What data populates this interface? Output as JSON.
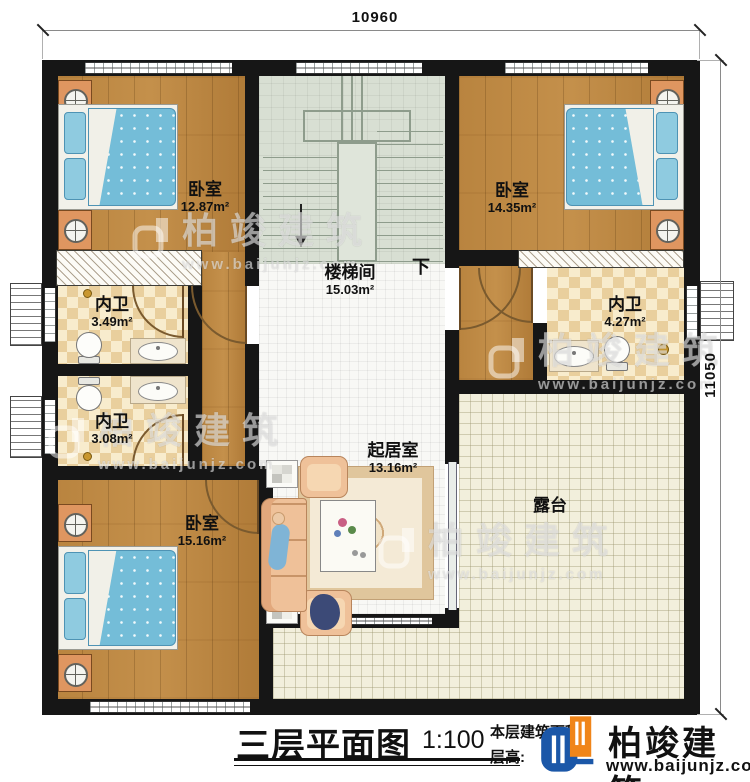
{
  "meta": {
    "sheet_title": "三层平面图",
    "scale": "1:100",
    "note_area_label": "本层建筑面积",
    "note_height_label": "层高:",
    "dim_width": "10960",
    "dim_height": "11050",
    "stair_direction": "下"
  },
  "rooms": {
    "bedroom1": {
      "name": "卧室",
      "area": "12.87m²"
    },
    "bedroom2": {
      "name": "卧室",
      "area": "14.35m²"
    },
    "stair": {
      "name": "楼梯间",
      "area": "15.03m²"
    },
    "bath1": {
      "name": "内卫",
      "area": "3.49m²"
    },
    "bath2": {
      "name": "内卫",
      "area": "3.08m²"
    },
    "bath3": {
      "name": "内卫",
      "area": "4.27m²"
    },
    "bedroom3": {
      "name": "卧室",
      "area": "15.16m²"
    },
    "living": {
      "name": "起居室",
      "area": "13.16m²"
    },
    "terrace": {
      "name": "露台"
    }
  },
  "brand": {
    "name": "柏竣建筑",
    "url": "www.baijunjz.com"
  },
  "watermark": {
    "name": "柏竣建筑",
    "url": "www.baijunjz.com"
  },
  "colors": {
    "wall": "#161616",
    "wood": "#b9843f",
    "checker": "#e9cf9d",
    "stair_floor": "#d8dfd3",
    "terrace_floor": "#f2efdc",
    "bed_blue": "#74bdd8",
    "brand_blue": "#1b57a8",
    "brand_orange": "#f08519"
  }
}
